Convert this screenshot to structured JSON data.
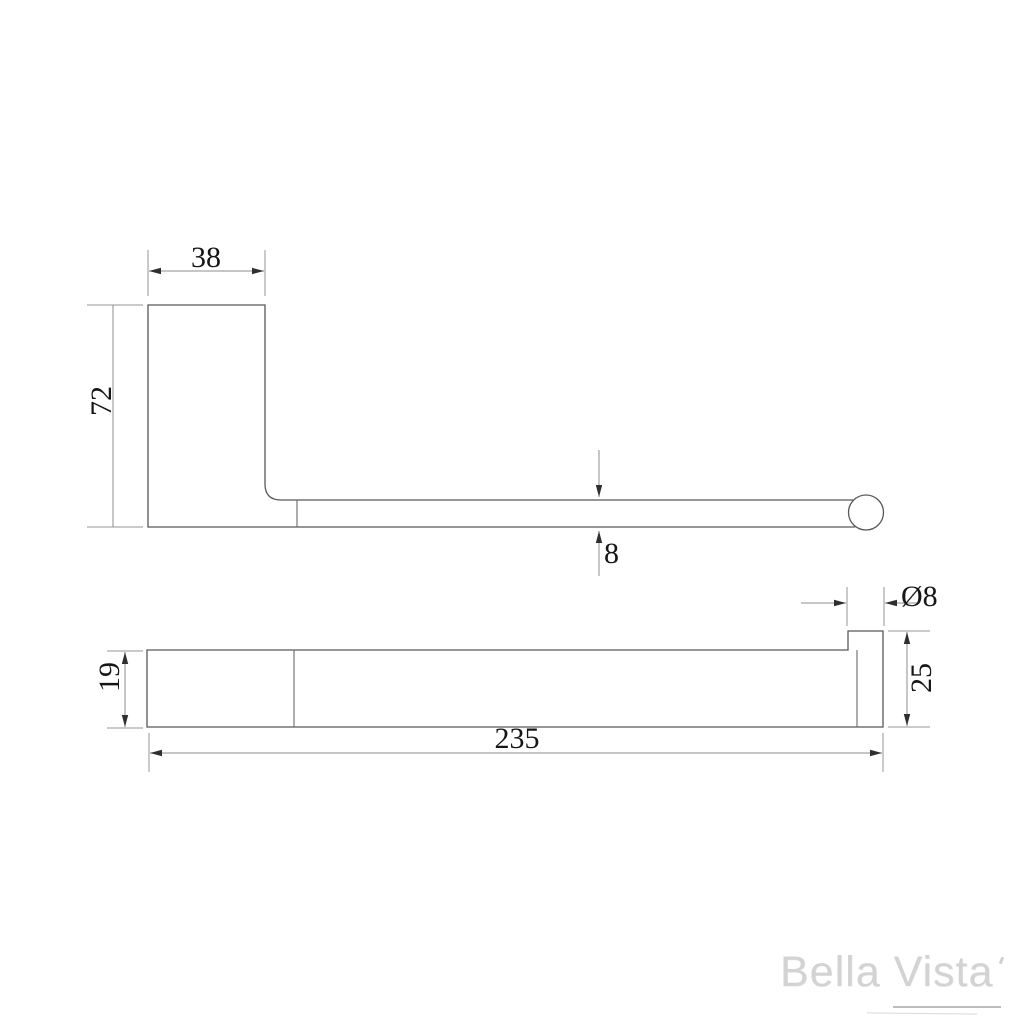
{
  "drawing": {
    "kind": "technical-dimension-drawing",
    "product": "wall-mounted rail bracket",
    "views": [
      {
        "id": "side-profile",
        "description": "L-shaped side elevation with round rail end"
      },
      {
        "id": "top-plan",
        "description": "plan view of plate and rail end cap"
      }
    ]
  },
  "dimensions": {
    "bracket_width": "38",
    "bracket_height": "72",
    "rail_thickness": "8",
    "plate_depth": "19",
    "overall_length": "235",
    "rail_diameter": "Ø8",
    "end_cap_depth": "25"
  },
  "branding": {
    "logo_text": "Bella Vista"
  },
  "colors": {
    "background": "#ffffff",
    "shape_line": "#585858",
    "dimension_line": "#8d8d8d",
    "dimension_text": "#161616",
    "logo_text": "#d3d3d3"
  }
}
